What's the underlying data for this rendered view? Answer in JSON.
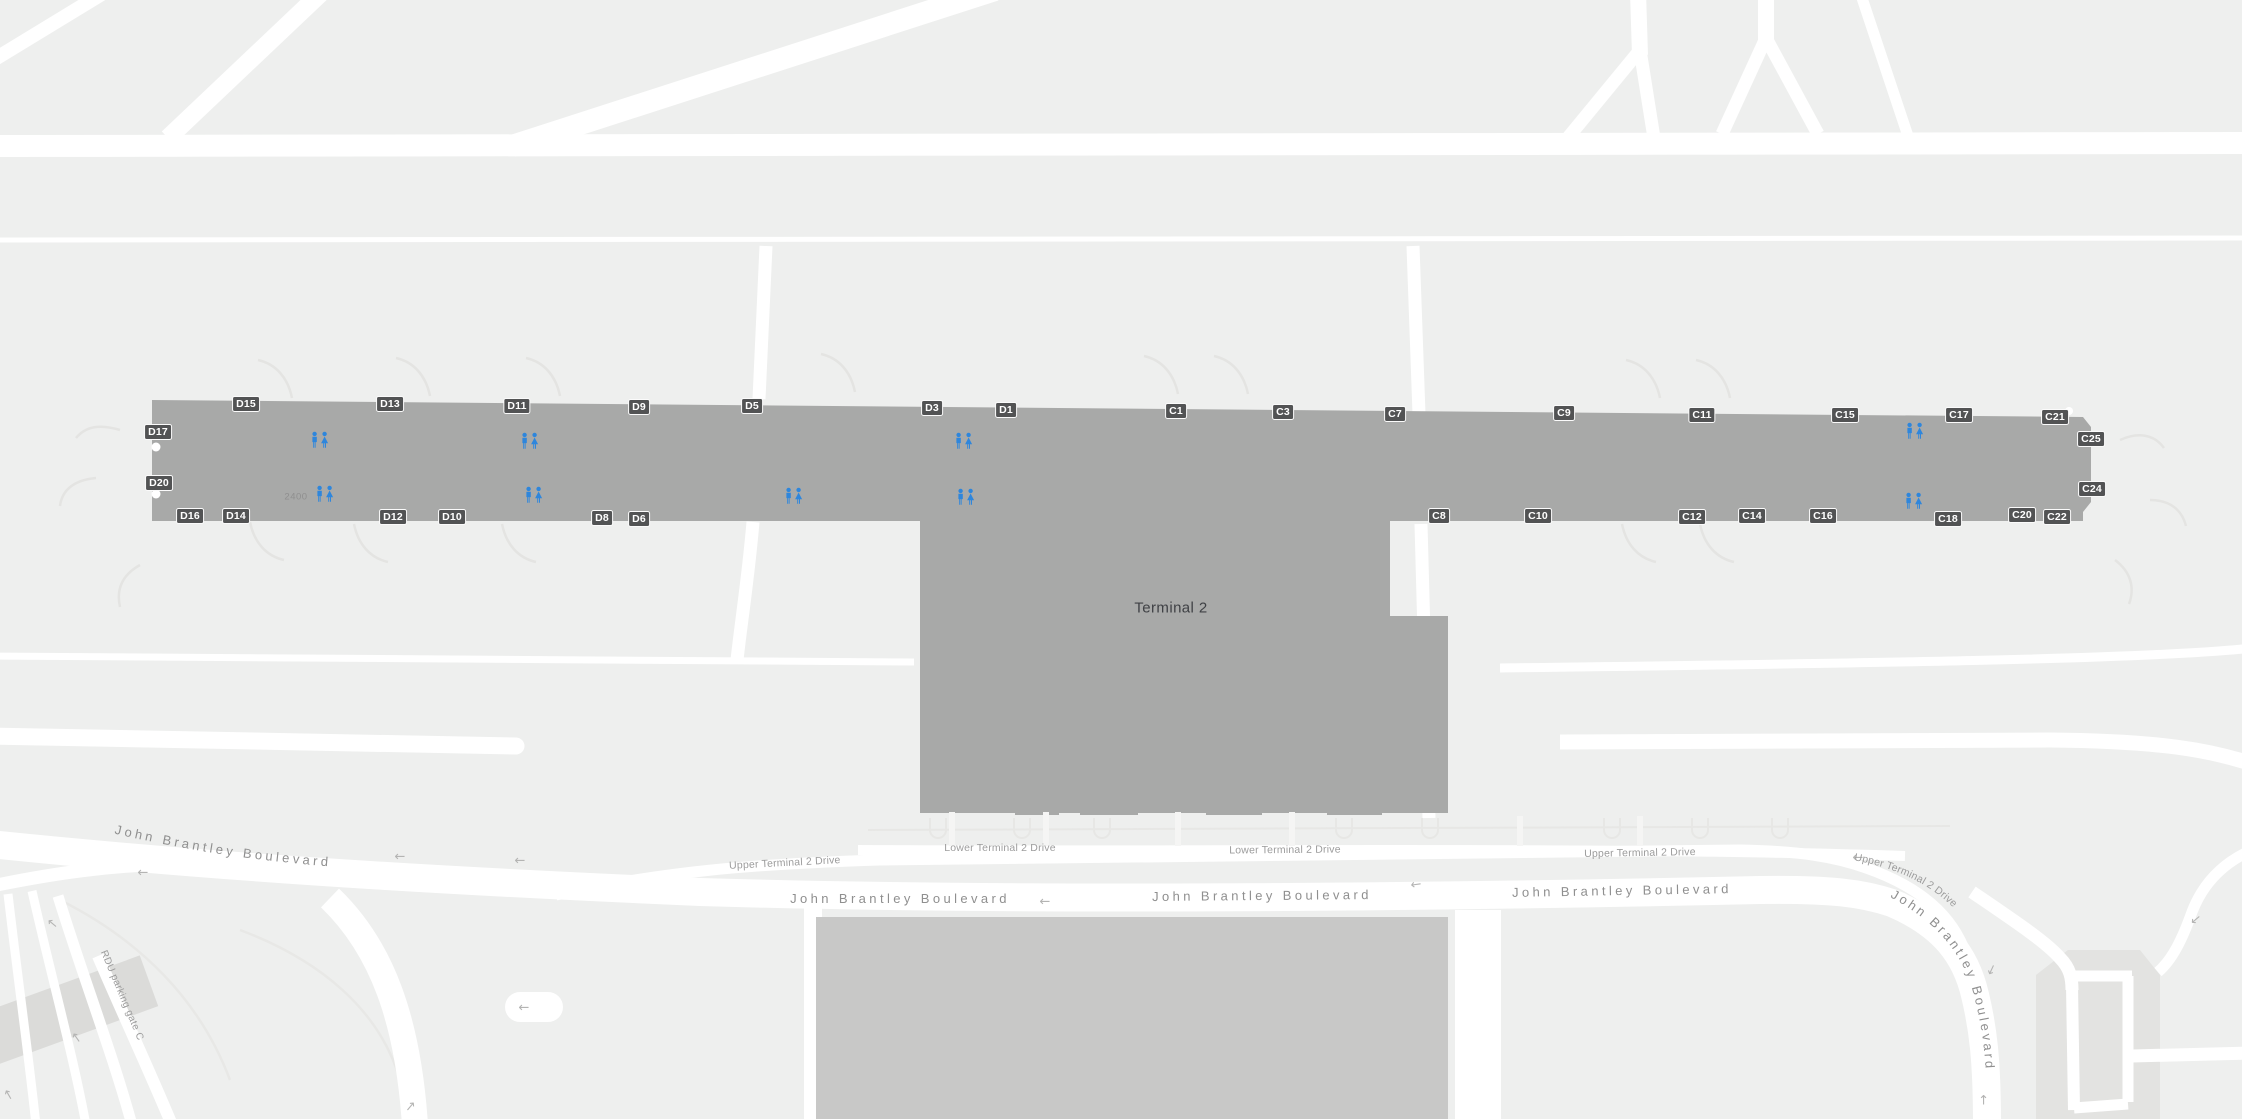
{
  "map": {
    "terminal_label": "Terminal 2",
    "room_number": "2400",
    "arrow_glyph": "←",
    "colors": {
      "background": "#eeefee",
      "road": "#ffffff",
      "concourse": "#a8a9a8",
      "building_lower": "#c8c8c7",
      "gate_chip_bg": "#525354",
      "gate_chip_border": "#fbfbfb",
      "gate_chip_text": "#ffffff",
      "restroom_blue": "#2e86dc",
      "blvd_label": "#8f8f8f",
      "drive_label": "#9c9c9c",
      "terminal_text": "#3f4145",
      "room_text": "#8f8f8f",
      "arrow_color": "#b4b4b3",
      "shadow": "#e3e3e1",
      "decor_line": "#e4e4e2",
      "parking_bldg": "#dbdbd9"
    },
    "gates": [
      {
        "id": "D17",
        "x": 158,
        "y": 432
      },
      {
        "id": "D20",
        "x": 159,
        "y": 483
      },
      {
        "id": "D15",
        "x": 246,
        "y": 404
      },
      {
        "id": "D13",
        "x": 390,
        "y": 404
      },
      {
        "id": "D11",
        "x": 517,
        "y": 406
      },
      {
        "id": "D9",
        "x": 639,
        "y": 407
      },
      {
        "id": "D5",
        "x": 752,
        "y": 406
      },
      {
        "id": "D3",
        "x": 932,
        "y": 408
      },
      {
        "id": "D1",
        "x": 1006,
        "y": 410
      },
      {
        "id": "D16",
        "x": 190,
        "y": 516
      },
      {
        "id": "D14",
        "x": 236,
        "y": 516
      },
      {
        "id": "D12",
        "x": 393,
        "y": 517
      },
      {
        "id": "D10",
        "x": 452,
        "y": 517
      },
      {
        "id": "D8",
        "x": 602,
        "y": 518
      },
      {
        "id": "D6",
        "x": 639,
        "y": 519
      },
      {
        "id": "C1",
        "x": 1176,
        "y": 411
      },
      {
        "id": "C3",
        "x": 1283,
        "y": 412
      },
      {
        "id": "C7",
        "x": 1395,
        "y": 414
      },
      {
        "id": "C9",
        "x": 1564,
        "y": 413
      },
      {
        "id": "C11",
        "x": 1702,
        "y": 415
      },
      {
        "id": "C15",
        "x": 1845,
        "y": 415
      },
      {
        "id": "C17",
        "x": 1959,
        "y": 415
      },
      {
        "id": "C21",
        "x": 2055,
        "y": 417
      },
      {
        "id": "C25",
        "x": 2091,
        "y": 439
      },
      {
        "id": "C24",
        "x": 2092,
        "y": 489
      },
      {
        "id": "C8",
        "x": 1439,
        "y": 516
      },
      {
        "id": "C10",
        "x": 1538,
        "y": 516
      },
      {
        "id": "C12",
        "x": 1692,
        "y": 517
      },
      {
        "id": "C14",
        "x": 1752,
        "y": 516
      },
      {
        "id": "C16",
        "x": 1823,
        "y": 516
      },
      {
        "id": "C18",
        "x": 1948,
        "y": 519
      },
      {
        "id": "C20",
        "x": 2022,
        "y": 515
      },
      {
        "id": "C22",
        "x": 2057,
        "y": 517
      }
    ],
    "restrooms": [
      {
        "x": 320,
        "y": 440
      },
      {
        "x": 530,
        "y": 441
      },
      {
        "x": 964,
        "y": 441
      },
      {
        "x": 1915,
        "y": 431
      },
      {
        "x": 325,
        "y": 494
      },
      {
        "x": 534,
        "y": 495
      },
      {
        "x": 794,
        "y": 496
      },
      {
        "x": 966,
        "y": 497
      },
      {
        "x": 1914,
        "y": 501
      }
    ],
    "road_labels": [
      {
        "text": "John Brantley Boulevard",
        "curve": "p-jbb-left",
        "size": 13,
        "spacing": 3.4,
        "tone": "blvd"
      },
      {
        "text": "John Brantley Boulevard",
        "x": 900,
        "y": 903,
        "rotate": 0,
        "size": 13,
        "spacing": 3.4,
        "tone": "blvd"
      },
      {
        "text": "John Brantley Boulevard",
        "x": 1262,
        "y": 900,
        "rotate": -0.5,
        "size": 13,
        "spacing": 3.4,
        "tone": "blvd"
      },
      {
        "text": "John Brantley Boulevard",
        "x": 1622,
        "y": 895,
        "rotate": -1,
        "size": 13,
        "spacing": 3.4,
        "tone": "blvd"
      },
      {
        "text": "John Brantley Boulevard",
        "curve": "p-jbb-right",
        "size": 13,
        "spacing": 3.0,
        "tone": "blvd"
      },
      {
        "text": "Upper Terminal 2 Drive",
        "x": 785,
        "y": 866,
        "rotate": -3,
        "size": 10.5,
        "spacing": 0.2,
        "tone": "drive"
      },
      {
        "text": "Upper Terminal 2 Drive",
        "x": 1640,
        "y": 856,
        "rotate": -1,
        "size": 10.5,
        "spacing": 0.2,
        "tone": "drive"
      },
      {
        "text": "Upper Terminal 2 Drive",
        "curve": "p-ut2d-r",
        "size": 10.5,
        "spacing": 0.2,
        "tone": "drive"
      },
      {
        "text": "Lower Terminal 2 Drive",
        "x": 1000,
        "y": 851,
        "rotate": 0,
        "size": 10.5,
        "spacing": 0.2,
        "tone": "drive"
      },
      {
        "text": "Lower Terminal 2 Drive",
        "x": 1285,
        "y": 853,
        "rotate": -0.5,
        "size": 10.5,
        "spacing": 0.2,
        "tone": "drive"
      },
      {
        "text": "RDU parking gate C",
        "curve": "p-rdu",
        "size": 10,
        "spacing": 0.4,
        "tone": "drive"
      }
    ],
    "arrows": [
      {
        "x": 400,
        "y": 857,
        "r": 0
      },
      {
        "x": 520,
        "y": 861,
        "r": 0
      },
      {
        "x": 143,
        "y": 873,
        "r": 0
      },
      {
        "x": 1045,
        "y": 902,
        "r": 0
      },
      {
        "x": 1416,
        "y": 885,
        "r": -8
      },
      {
        "x": 1858,
        "y": 858,
        "r": 0
      },
      {
        "x": 52,
        "y": 924,
        "r": 40
      },
      {
        "x": 76,
        "y": 1038,
        "r": 55
      },
      {
        "x": 8,
        "y": 1095,
        "r": 60
      },
      {
        "x": 524,
        "y": 1008,
        "r": 0
      },
      {
        "x": 1992,
        "y": 970,
        "r": -65
      },
      {
        "x": 1983,
        "y": 1100,
        "r": 90
      },
      {
        "x": 410,
        "y": 1106,
        "r": 130
      },
      {
        "x": 2196,
        "y": 920,
        "r": -40
      }
    ]
  }
}
